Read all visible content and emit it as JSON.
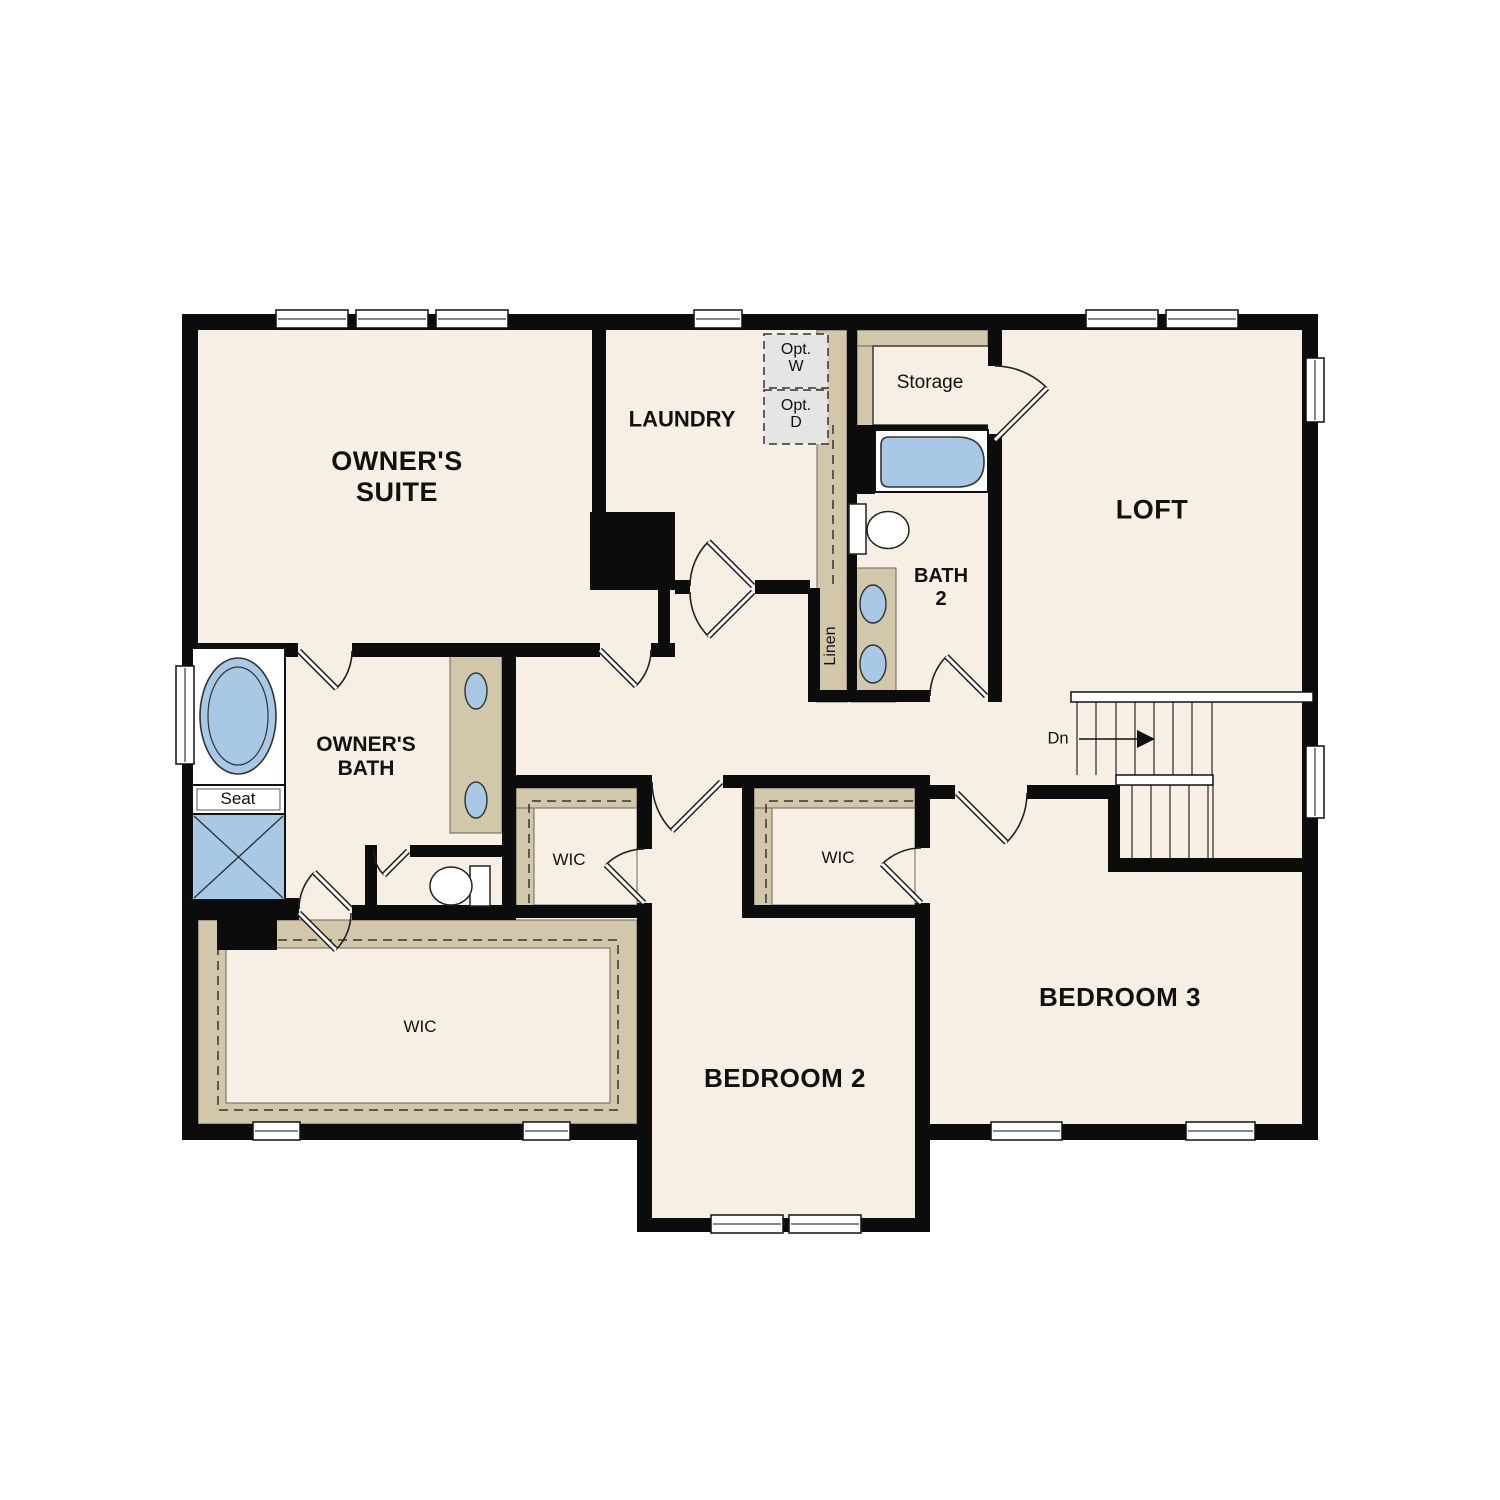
{
  "floorplan": {
    "title": "Second floor residential floor plan",
    "rooms": {
      "owners_suite_line1": "OWNER'S",
      "owners_suite_line2": "SUITE",
      "laundry": "LAUNDRY",
      "loft": "LOFT",
      "storage": "Storage",
      "bath2_line1": "BATH",
      "bath2_line2": "2",
      "owners_bath_line1": "OWNER'S",
      "owners_bath_line2": "BATH",
      "bedroom2": "BEDROOM 2",
      "bedroom3": "BEDROOM 3",
      "wic_hall": "WIC",
      "wic_bedroom3": "WIC",
      "wic_owners": "WIC",
      "linen": "Linen",
      "seat": "Seat",
      "opt_washer_line1": "Opt.",
      "opt_washer_line2": "W",
      "opt_dryer_line1": "Opt.",
      "opt_dryer_line2": "D",
      "stairs_down": "Dn"
    },
    "colors": {
      "floor": "#f7eee4",
      "wall": "#0c0c0c",
      "closet_tan": "#d2c7ab",
      "fixture_blue": "#a8c8e6",
      "optional_gray": "#e5e6e3"
    }
  }
}
